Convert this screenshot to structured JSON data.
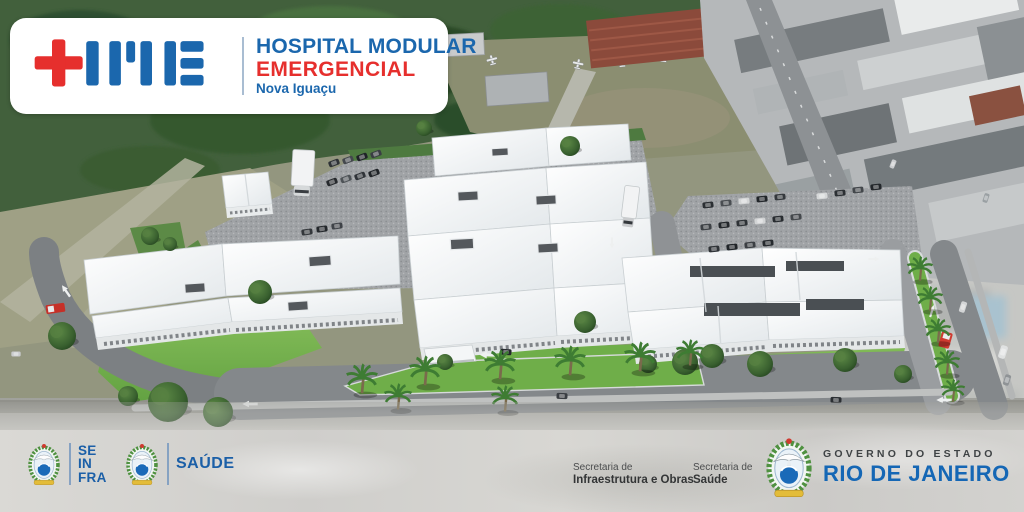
{
  "brand": {
    "acronym": "HME",
    "name_line1": "HOSPITAL MODULAR",
    "name_line2": "EMERGENCIAL",
    "location": "Nova Iguaçu",
    "colors": {
      "blue": "#1b67ad",
      "red": "#e62f2d"
    }
  },
  "footer": {
    "seinfra": {
      "lines": [
        "SE",
        "IN",
        "FRA"
      ]
    },
    "saude": {
      "label": "SAÚDE"
    },
    "secretaria_infraestrutura": {
      "line1": "Secretaria de",
      "line2": "Infraestrutura e Obras"
    },
    "secretaria_saude": {
      "line1": "Secretaria de",
      "line2": "Saúde"
    },
    "governo": {
      "line1": "GOVERNO DO ESTADO",
      "line2": "RIO DE JANEIRO"
    },
    "colors": {
      "logo_blue": "#1b5fa7",
      "rio_blue": "#1567b5",
      "text_dark": "#3f4345"
    }
  },
  "scene": {
    "subject": "aerial-rendering-of-modular-emergency-hospital-campus",
    "palette": {
      "grass": "#74b14a",
      "roof": "#f3f6f7",
      "gravel": "#9fa1a4",
      "asphalt": "#84888b",
      "trees": "#3c6135",
      "photo_field": "#93967f"
    }
  }
}
